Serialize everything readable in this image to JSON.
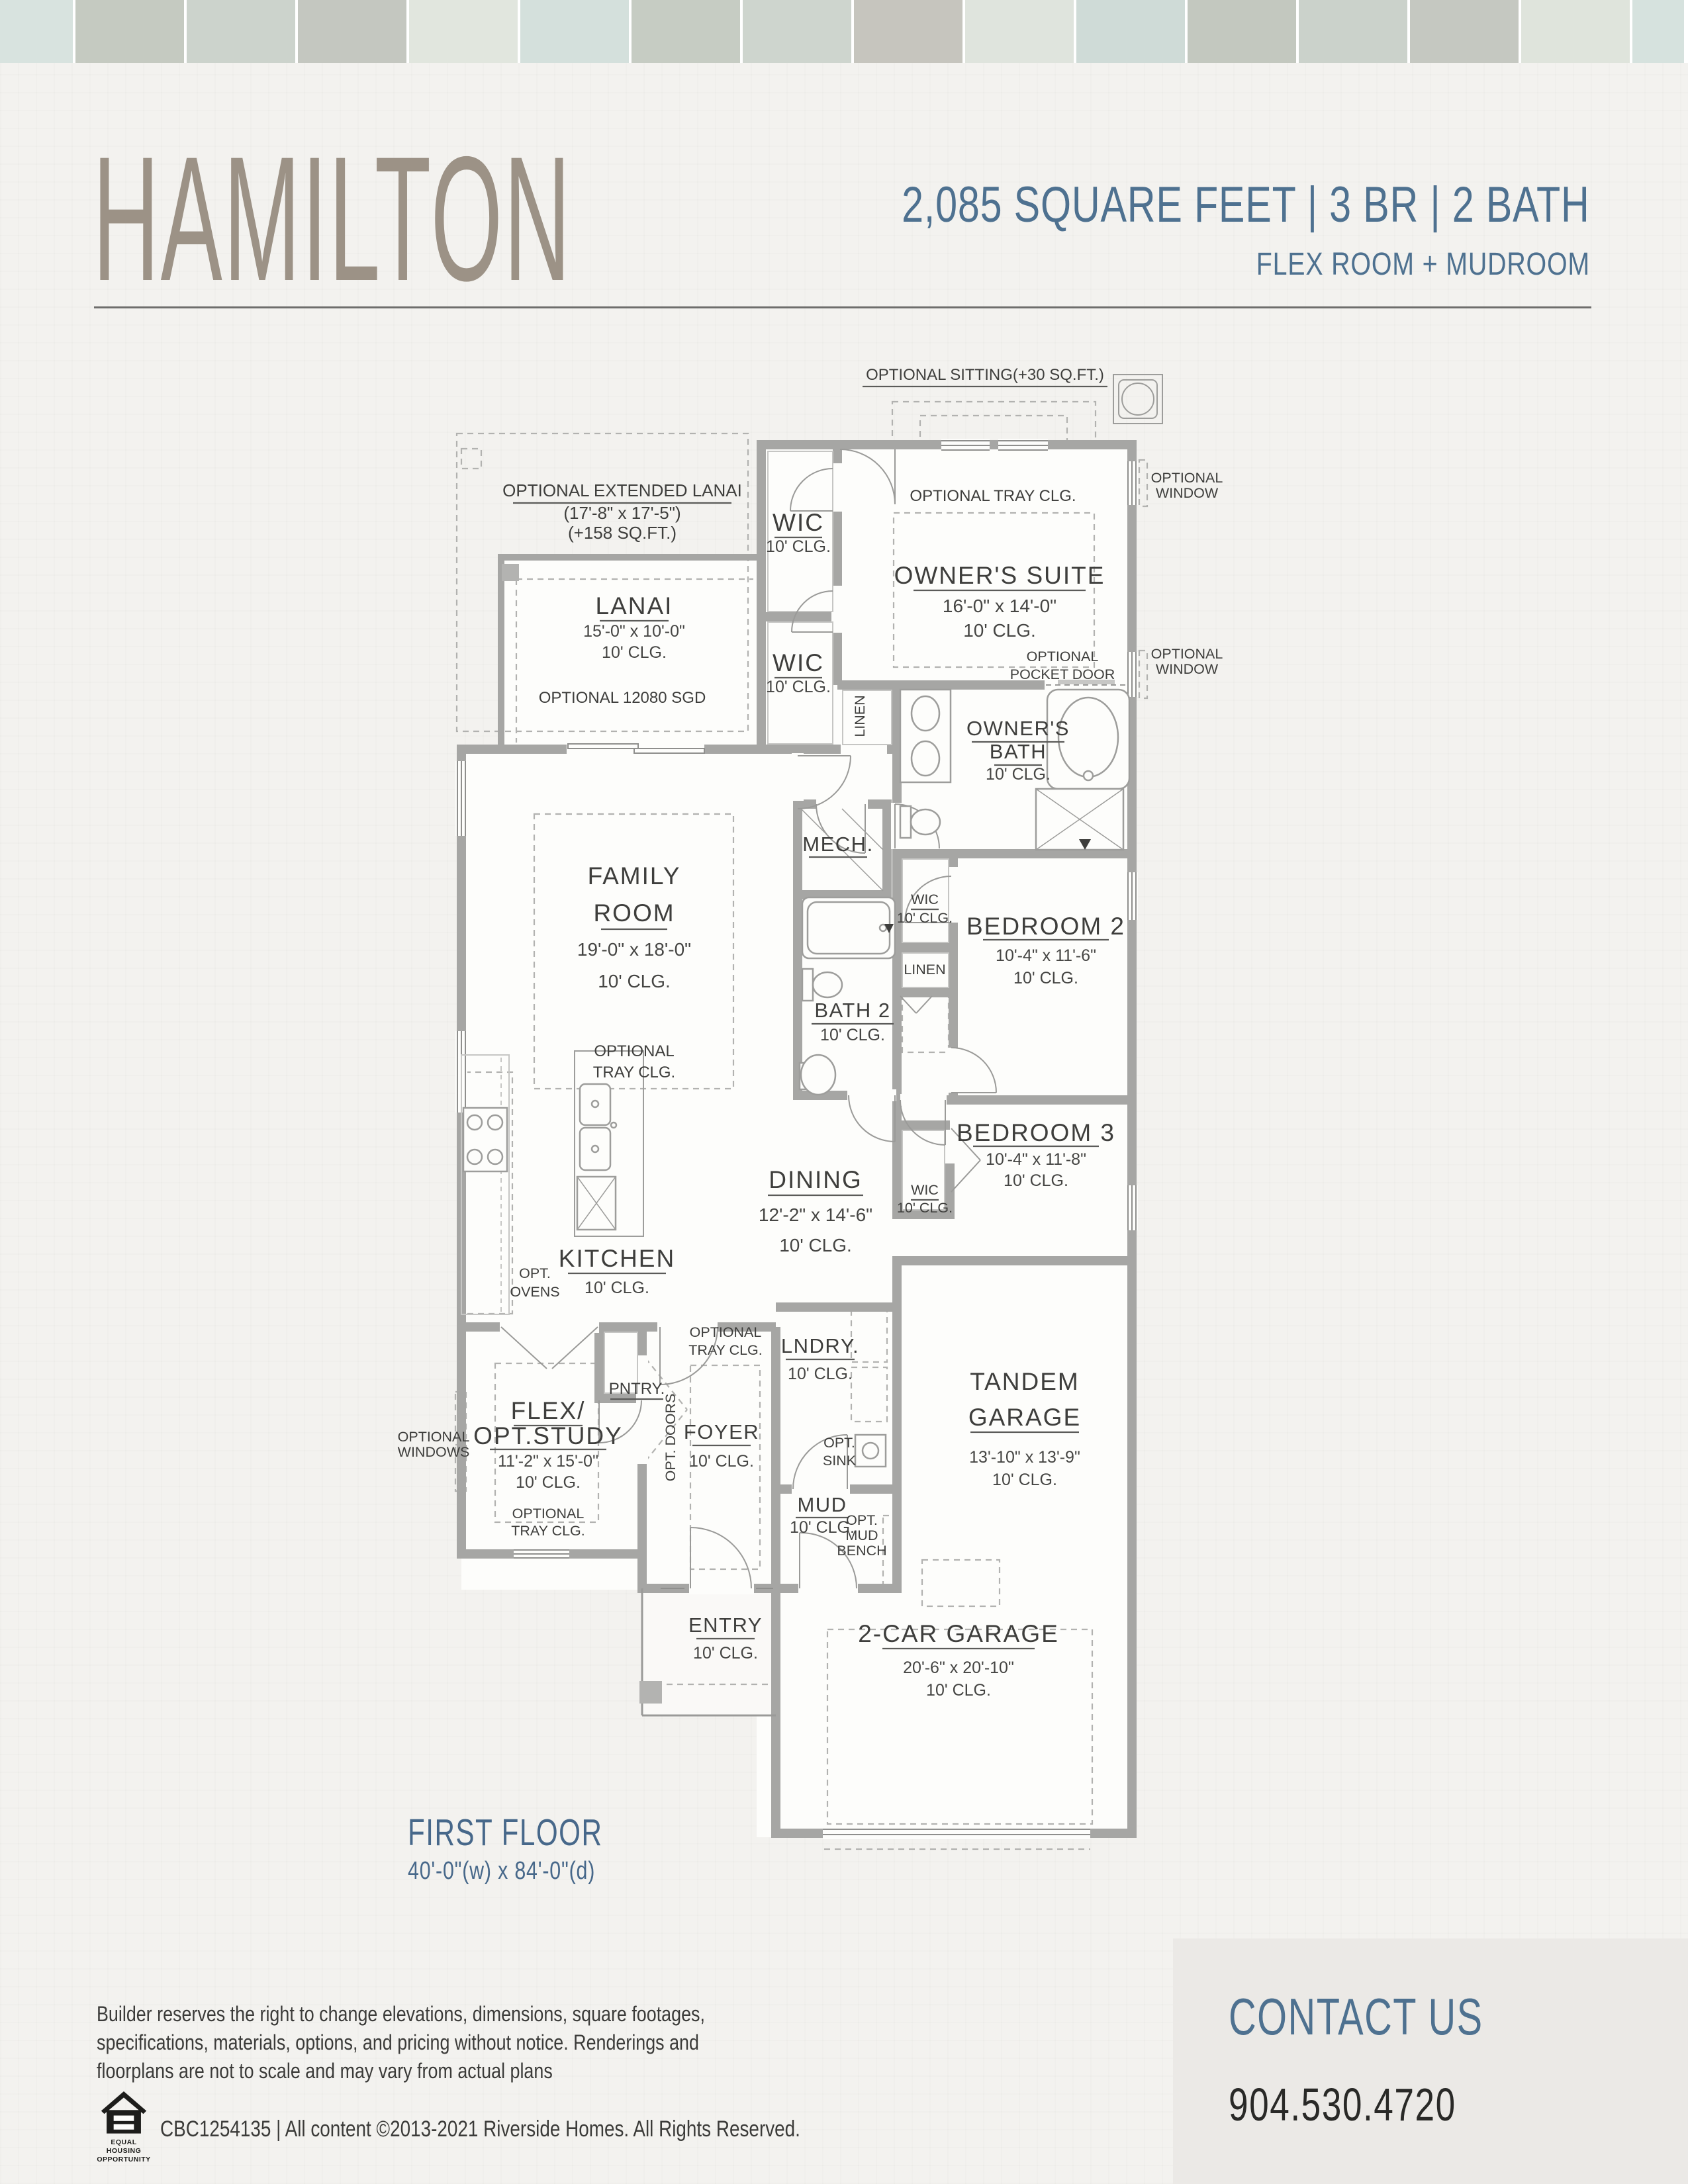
{
  "top_strip": {
    "tiles": [
      {
        "style": "background:#d8e3df;width:110px"
      },
      {
        "style": "background:#c5cac1;width:164px"
      },
      {
        "style": "background:#ccd3cc;width:164px"
      },
      {
        "style": "background:#c4c7c0;width:164px"
      },
      {
        "style": "background:#e1e6de;width:164px"
      },
      {
        "style": "background:#d4e0dc;width:164px"
      },
      {
        "style": "background:#c6ccc3;width:164px"
      },
      {
        "style": "background:#ced5ce;width:164px"
      },
      {
        "style": "background:#c6c5be;width:164px"
      },
      {
        "style": "background:#dfe4dd;width:164px"
      },
      {
        "style": "background:#cfdbd7;width:164px"
      },
      {
        "style": "background:#c3c8bf;width:164px"
      },
      {
        "style": "background:#cbd2cb;width:164px"
      },
      {
        "style": "background:#c5c8c1;width:164px"
      },
      {
        "style": "background:#dfe4dc;width:164px"
      },
      {
        "style": "background:#d6e2de;width:78px"
      }
    ]
  },
  "header": {
    "title": "HAMILTON",
    "specs": "2,085 SQUARE FEET  |  3 BR  |  2 BATH",
    "subtitle": "FLEX ROOM + MUDROOM"
  },
  "plan": {
    "optional_sitting": "OPTIONAL SITTING(+30 SQ.FT.)",
    "owners_suite": {
      "tray": "OPTIONAL TRAY CLG.",
      "name": "OWNER'S SUITE",
      "dims": "16'-0\" x 14'-0\"",
      "clg": "10' CLG."
    },
    "opt_window_a": {
      "l1": "OPTIONAL",
      "l2": "WINDOW"
    },
    "opt_window_b": {
      "l1": "OPTIONAL",
      "l2": "WINDOW"
    },
    "wic1": {
      "name": "WIC",
      "clg": "10' CLG."
    },
    "wic2": {
      "name": "WIC",
      "clg": "10' CLG."
    },
    "linen1": "LINEN",
    "ext_lanai": {
      "l1": "OPTIONAL EXTENDED LANAI",
      "l2": "(17'-8\" x 17'-5\")",
      "l3": "(+158 SQ.FT.)"
    },
    "lanai": {
      "name": "LANAI",
      "dims": "15'-0\" x 10'-0\"",
      "clg": "10' CLG.",
      "sgd": "OPTIONAL 12080 SGD"
    },
    "pocket_door": {
      "l1": "OPTIONAL",
      "l2": "POCKET DOOR"
    },
    "owners_bath": {
      "l1": "OWNER'S",
      "l2": "BATH",
      "clg": "10' CLG."
    },
    "mech": "MECH.",
    "family": {
      "l1": "FAMILY",
      "l2": "ROOM",
      "dims": "19'-0\" x 18'-0\"",
      "clg": "10' CLG.",
      "tray1": "OPTIONAL",
      "tray2": "TRAY CLG."
    },
    "bath2": {
      "name": "BATH 2",
      "clg": "10' CLG."
    },
    "wic_b2": {
      "name": "WIC",
      "clg": "10' CLG."
    },
    "linen2": "LINEN",
    "bedroom2": {
      "name": "BEDROOM 2",
      "dims": "10'-4\" x 11'-6\"",
      "clg": "10' CLG."
    },
    "bedroom3": {
      "name": "BEDROOM 3",
      "dims": "10'-4\" x 11'-8\"",
      "clg": "10' CLG."
    },
    "wic_b3": {
      "name": "WIC",
      "clg": "10' CLG."
    },
    "dining": {
      "name": "DINING",
      "dims": "12'-2\" x 14'-6\"",
      "clg": "10' CLG."
    },
    "kitchen": {
      "name": "KITCHEN",
      "clg": "10' CLG.",
      "opt1": "OPT.",
      "opt2": "OVENS",
      "pantry": "PNTRY."
    },
    "foyer": {
      "name": "FOYER",
      "clg": "10' CLG.",
      "tray1": "OPTIONAL",
      "tray2": "TRAY CLG.",
      "doors": "OPT. DOORS"
    },
    "lndry": {
      "name": "LNDRY.",
      "clg": "10' CLG.",
      "sink1": "OPT.",
      "sink2": "SINK"
    },
    "mud": {
      "name": "MUD",
      "clg": "10' CLG.",
      "bench1": "OPT.",
      "bench2": "MUD",
      "bench3": "BENCH"
    },
    "tandem": {
      "l1": "TANDEM",
      "l2": "GARAGE",
      "dims": "13'-10\" x 13'-9\"",
      "clg": "10' CLG."
    },
    "flex": {
      "l1": "FLEX/",
      "l2": "OPT.STUDY",
      "dims": "11'-2\" x 15'-0\"",
      "clg": "10' CLG.",
      "tray1": "OPTIONAL",
      "tray2": "TRAY CLG.",
      "win1": "OPTIONAL",
      "win2": "WINDOWS"
    },
    "entry": {
      "name": "ENTRY",
      "clg": "10' CLG."
    },
    "garage2": {
      "name": "2-CAR GARAGE",
      "dims": "20'-6\" x 20'-10\"",
      "clg": "10' CLG."
    }
  },
  "first_floor": {
    "name": "FIRST FLOOR",
    "dims": "40'-0\"(w) x 84'-0\"(d)"
  },
  "contact": {
    "heading": "CONTACT US",
    "phone": "904.530.4720"
  },
  "footer": {
    "disclaimer1": "Builder reserves the right to change elevations, dimensions, square footages,",
    "disclaimer2": "specifications, materials, options, and pricing without notice. Renderings and",
    "disclaimer3": "floorplans are not to scale and may vary from actual plans",
    "license": "CBC1254135 | All content ©2013-2021 Riverside Homes. All Rights Reserved.",
    "eho1": "EQUAL HOUSING",
    "eho2": "OPPORTUNITY"
  }
}
